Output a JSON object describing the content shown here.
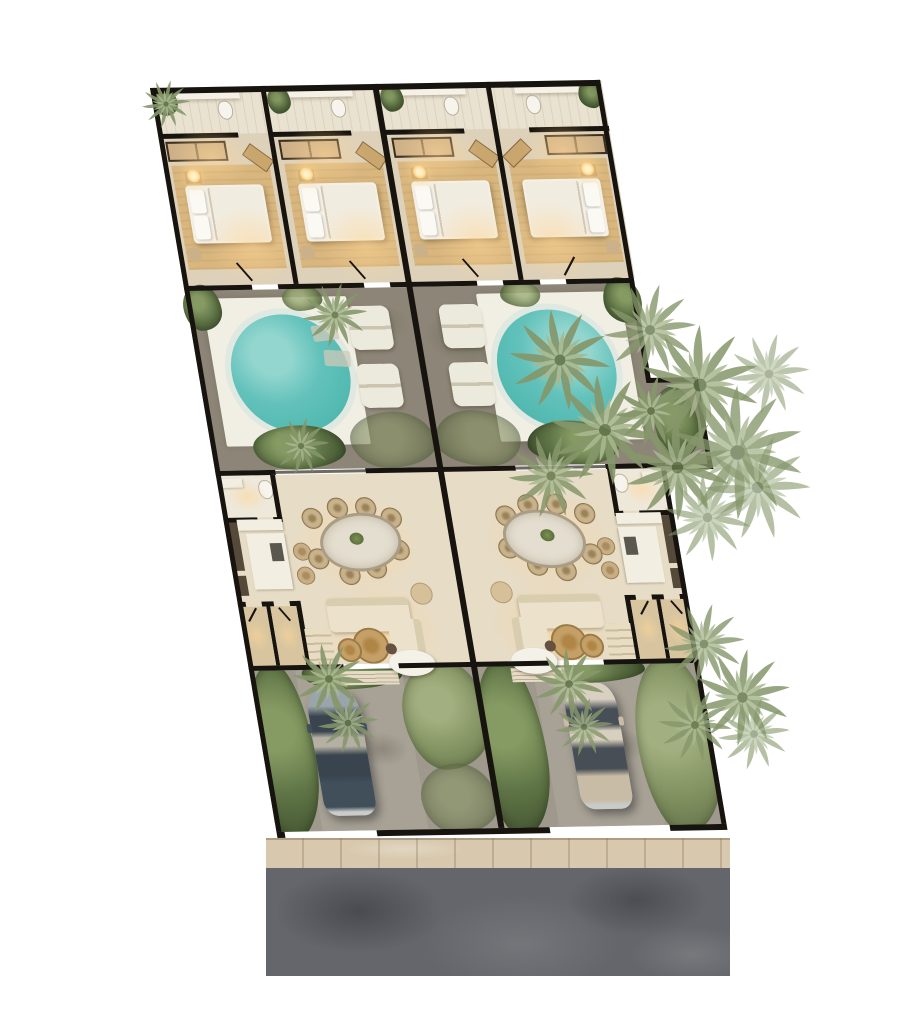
{
  "scene": {
    "type": "architectural-site-plan",
    "view": "top-down 3D rendered floor plan",
    "description": "Two mirrored twin villas sharing a party wall; each with two en-suite bedrooms at the rear, a stone courtyard with a round plunge pool and sun loungers, an open living-dining-kitchen level, a planted driveway with a parked car, fronted by a sidewalk and asphalt street. Palm trees overhang the right side.",
    "background": "#ffffff"
  },
  "villas": [
    {
      "id": "villa-left",
      "visible_features": [
        "2 bedrooms with double beds",
        "2 bathrooms with vanities",
        "wardrobes",
        "round plunge pool on white deck",
        "2 sun loungers",
        "oval dining table with 8 wicker chairs",
        "kitchen island with 2 bar stools",
        "L-shaped sofa with 2 round rattan coffee tables",
        "2 utility rooms and stairs",
        "stone driveway",
        "parked car"
      ],
      "car": {
        "color_name": "dark blue-gray"
      }
    },
    {
      "id": "villa-right",
      "visible_features": [
        "2 bedrooms with double beds",
        "2 bathrooms with vanities",
        "wardrobes",
        "round plunge pool on white deck",
        "2 sun loungers",
        "oval dining table with 8 wicker chairs",
        "kitchen island with 2 bar stools",
        "L-shaped sofa with 2 round rattan coffee tables",
        "2 utility rooms and stairs",
        "stone driveway",
        "parked car"
      ],
      "car": {
        "color_name": "champagne beige"
      }
    }
  ],
  "street": {
    "elements": [
      "beige sidewalk with expansion joints",
      "dark asphalt road"
    ]
  },
  "vegetation": [
    "palm tree canopies along right boundary",
    "palms over right courtyard",
    "shrubs beside pools",
    "ground cover along driveways"
  ],
  "counts": {
    "bedrooms": 4,
    "pools": 2,
    "cars": 2,
    "sun_loungers": 4,
    "dining_chairs_per_villa": 8
  },
  "colors": {
    "wall": "#17130e",
    "bedroomFloor": "#ddd1ba",
    "bathFloor": "#eae2d0",
    "rug": "#d8b67e",
    "bed": "#f4f0e6",
    "deck": "#f1eee4",
    "pool": "#54bab2",
    "poolRing": "#dfe9e1",
    "stone": "#8d8577",
    "stoneLight": "#a8a296",
    "livingFloor": "#e7dcc6",
    "counter": "#f2eee2",
    "cabinet": "#55493a",
    "roomTan": "#d8c5a0",
    "rattan": "#c49f66",
    "road": "#64666b",
    "sidewalk": "#d8c9ae",
    "carLeftBody": "#414f5b",
    "carRightBody": "#c9bca7",
    "glow": "#ffd696"
  }
}
